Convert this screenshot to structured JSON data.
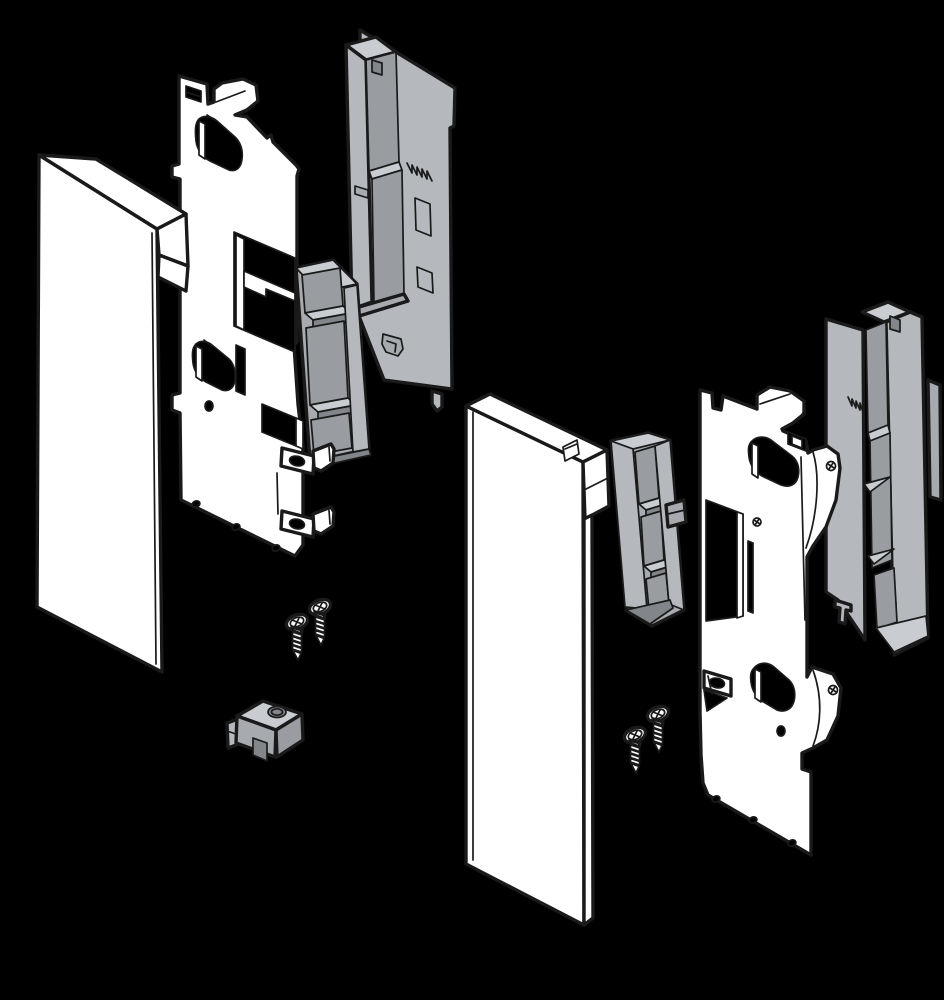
{
  "title": "Exploded assembly diagram of left and right drawer front fixing brackets",
  "palette": {
    "bg": "#000000",
    "line": "#1a1a1a",
    "white": "#ffffff",
    "gray_light": "#c9cdd1",
    "gray_mid": "#b5b9bd",
    "gray": "#a7abaf",
    "gray_dark": "#999da1",
    "gray_deep": "#82868a",
    "hole": "#000000"
  },
  "parts": {
    "left_assembly": "Left drawer front assembly",
    "left_front_panel": "Front panel (left)",
    "left_bracket_plate": "Front fixing bracket plate (left)",
    "left_insert_frame": "Insert frame (left)",
    "left_adapter_holder": "Adapter holder (left)",
    "left_screws": "Countersunk screws (left, 2x)",
    "clamp_nut": "Clamp nut block",
    "right_assembly": "Right drawer front assembly",
    "right_front_panel": "Front panel (right)",
    "right_bracket_plate": "Front fixing bracket plate (right)",
    "right_insert_frame": "Insert frame (right)",
    "right_adapter_holder": "Adapter holder (right)",
    "right_screws": "Countersunk screws (right, 2x)"
  },
  "counts": {
    "screws_left": 2,
    "screws_right": 2
  }
}
